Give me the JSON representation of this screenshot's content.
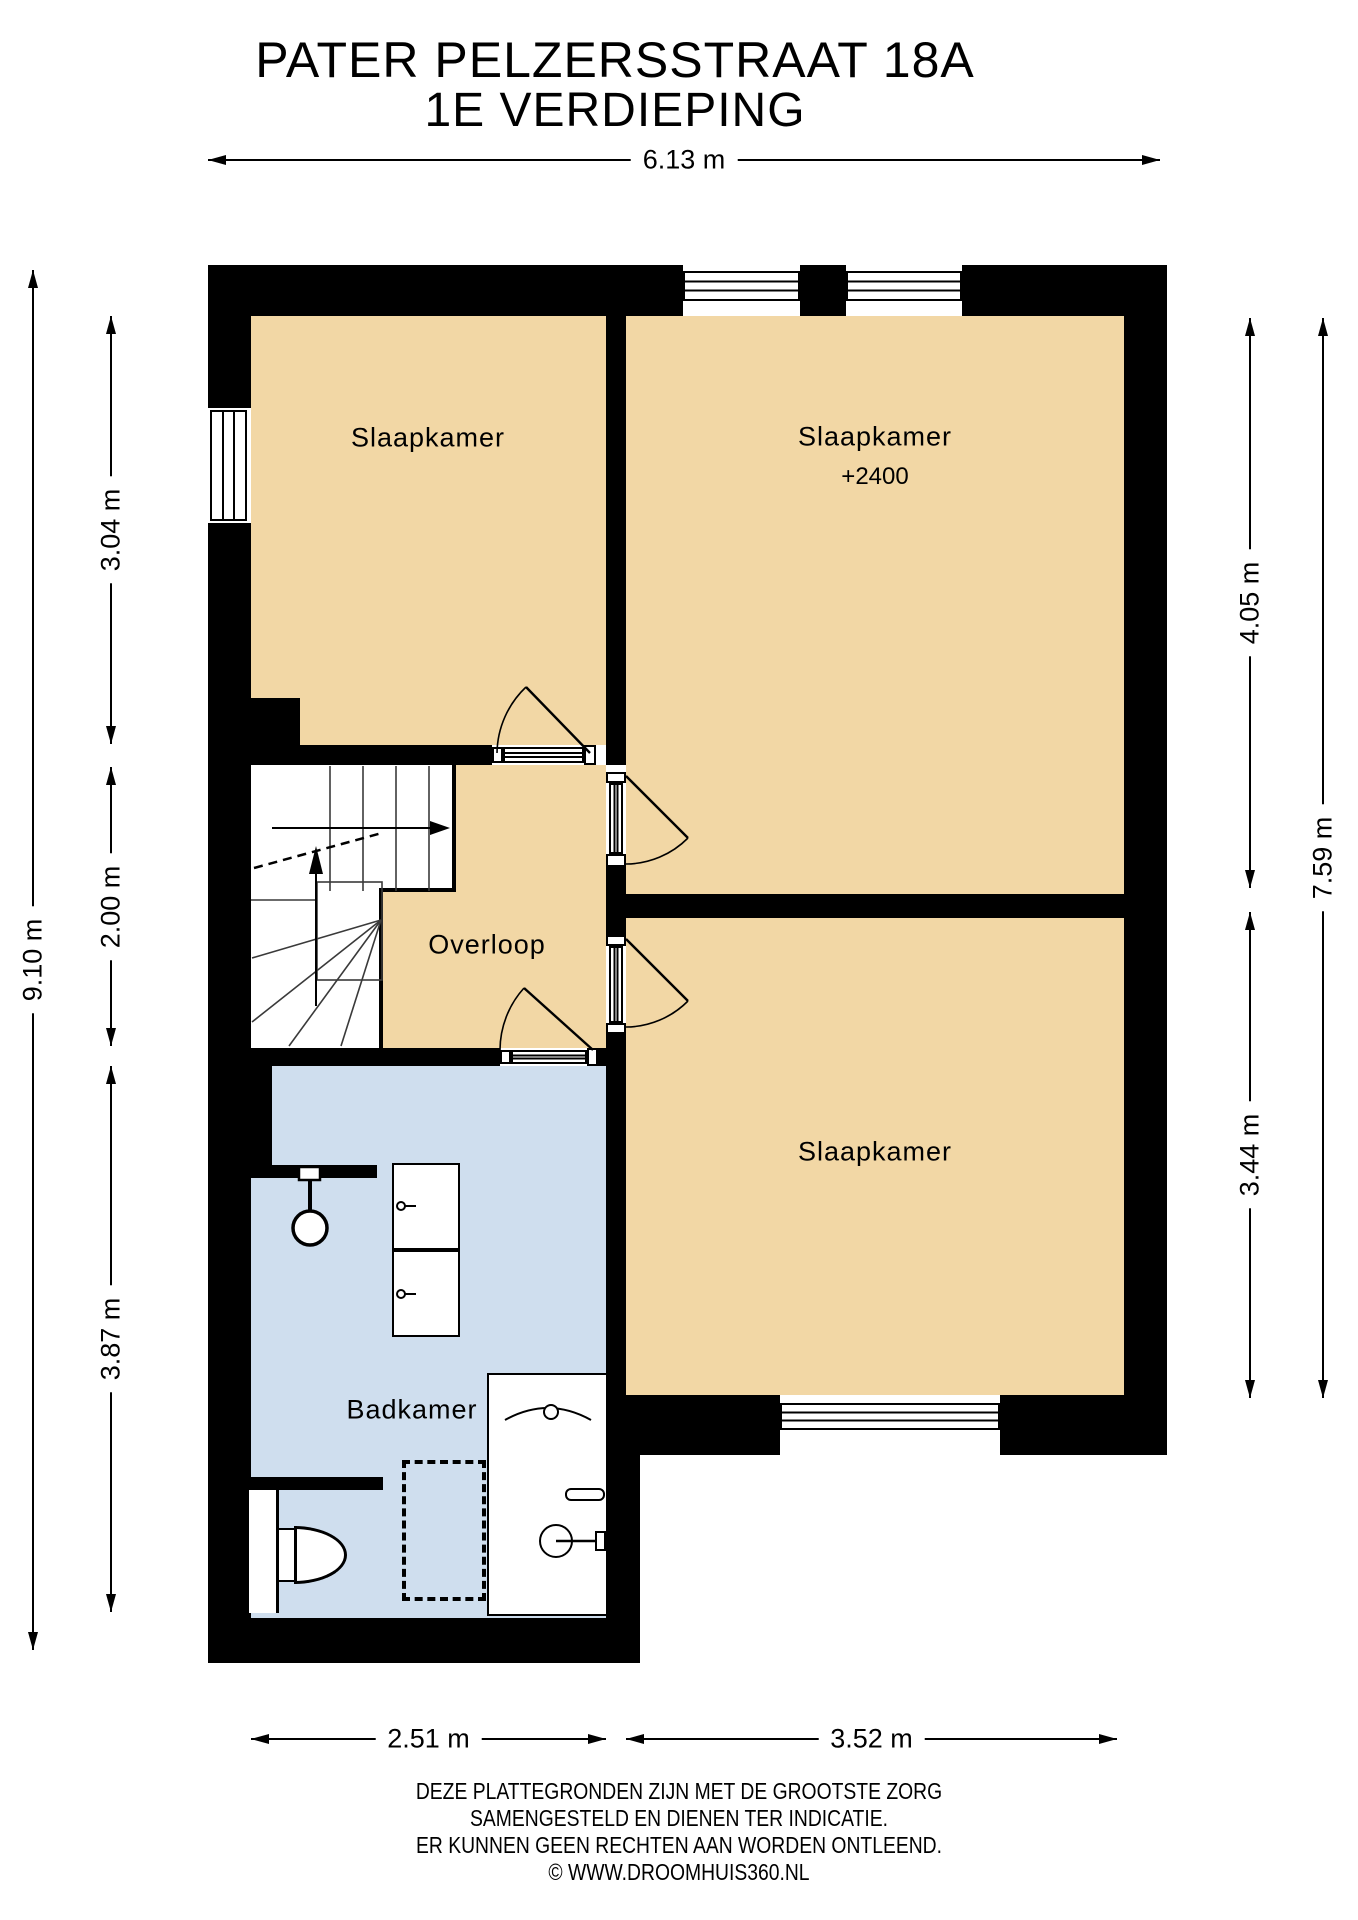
{
  "title": {
    "line1": "PATER PELZERSSTRAAT 18A",
    "line2": "1E VERDIEPING"
  },
  "rooms": {
    "bedroom_top_left": {
      "label": "Slaapkamer"
    },
    "bedroom_top_right": {
      "label": "Slaapkamer",
      "ceiling_height": "+2400"
    },
    "bedroom_bottom_right": {
      "label": "Slaapkamer"
    },
    "landing": {
      "label": "Overloop"
    },
    "bathroom": {
      "label": "Badkamer"
    }
  },
  "dimensions": {
    "total_width": "6.13 m",
    "total_height_left": "9.10 m",
    "bedroom_top_left_height": "3.04 m",
    "landing_height": "2.00 m",
    "bathroom_height": "3.87 m",
    "bedroom_top_right_height": "4.05 m",
    "bedroom_bottom_right_height": "3.44 m",
    "right_total_height": "7.59 m",
    "bottom_left_width": "2.51 m",
    "bottom_right_width": "3.52 m"
  },
  "footer": {
    "line1": "DEZE PLATTEGRONDEN ZIJN MET DE GROOTSTE ZORG",
    "line2": "SAMENGESTELD EN DIENEN TER INDICATIE.",
    "line3": "ER KUNNEN GEEN RECHTEN AAN WORDEN ONTLEEND.",
    "line4": "© WWW.DROOMHUIS360.NL"
  },
  "colors": {
    "wall": "#000000",
    "room_fill": "#f2d7a5",
    "bathroom_fill": "#cfdeee",
    "stair_line": "#3a3a3a"
  }
}
